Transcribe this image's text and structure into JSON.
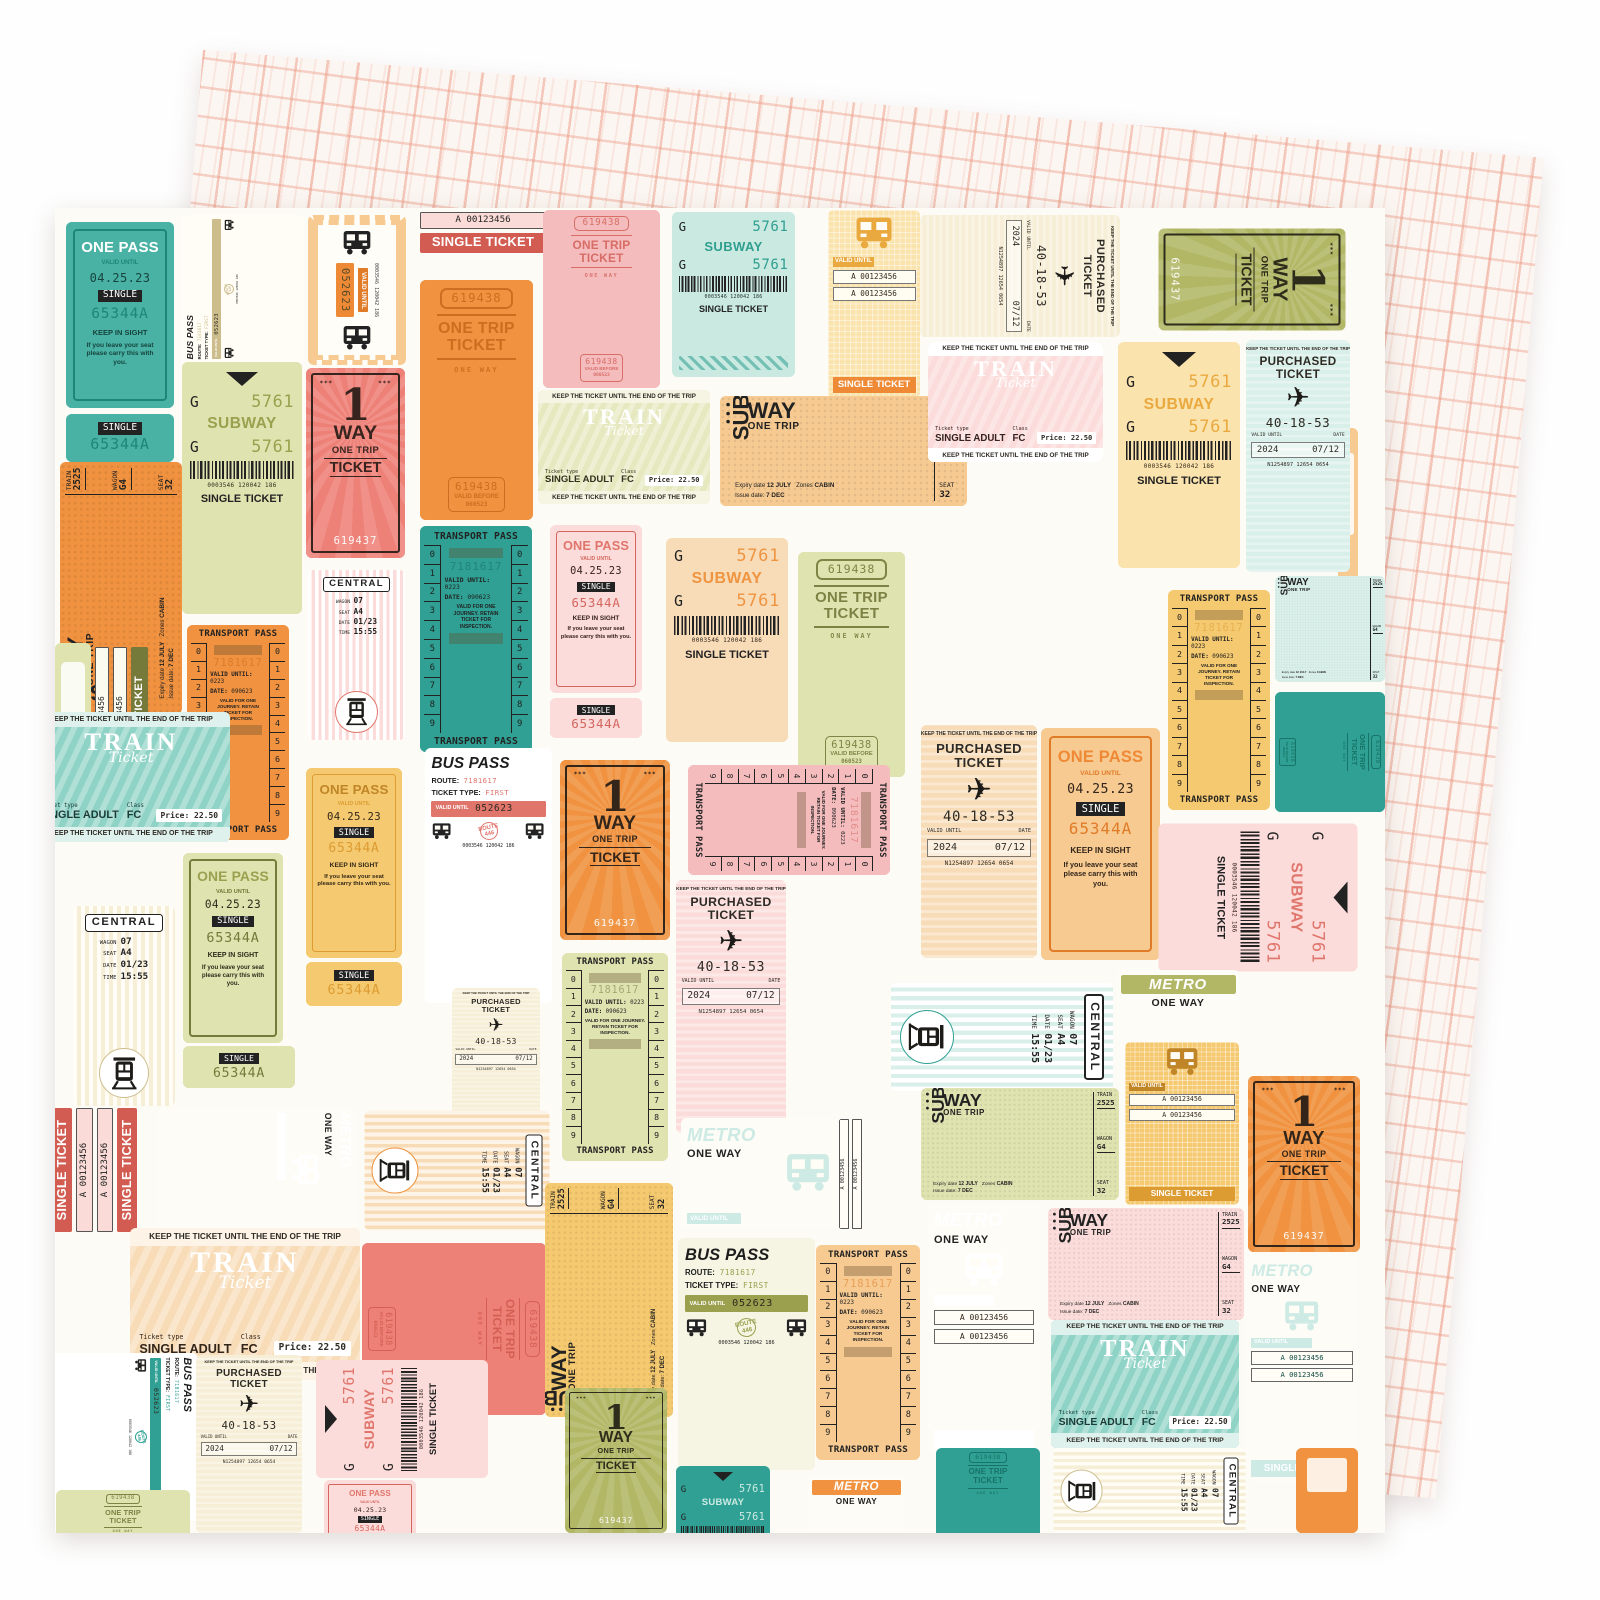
{
  "product": {
    "front_description": "Vintage transit ticket collage patterned paper",
    "back_description": "Pink hand-drawn grid patterned paper"
  },
  "palettes": {
    "teal": {
      "bg": "#49b2a4",
      "ink": "#16443d",
      "acc": "#ffffff",
      "dp": "#1f8578",
      "lt": "#dcf0ec"
    },
    "tealL": {
      "bg": "#c9e9e1",
      "ink": "#22302d",
      "acc": "#2f9f90",
      "dp": "#16796d",
      "lt": "#ffffff"
    },
    "tealD": {
      "bg": "#2fa093",
      "ink": "#0f4a42",
      "acc": "#cdeae4",
      "dp": "#156f64",
      "lt": "#e9f6f3"
    },
    "tealM": {
      "bg": "#8fd2c6",
      "ink": "#1c3b36",
      "acc": "#ffffff",
      "dp": "#2d9a8c",
      "lt": "#dff1ed"
    },
    "mint": {
      "bg": "#d9efe9",
      "ink": "#22302d",
      "acc": "#2fa093",
      "dp": "#1b7c70",
      "lt": "#ffffff"
    },
    "olive": {
      "bg": "#b2b766",
      "ink": "#2e2c1b",
      "acc": "#ffffff",
      "dp": "#6f743a",
      "lt": "#eff0da"
    },
    "oliveL": {
      "bg": "#dfe3b0",
      "ink": "#2e2c1b",
      "acc": "#9aa04e",
      "dp": "#75793a",
      "lt": "#fbfbef"
    },
    "lime": {
      "bg": "#e6e9c0",
      "ink": "#33311f",
      "acc": "#9aa04e",
      "dp": "#8f9448",
      "lt": "#f6f5e3"
    },
    "orange": {
      "bg": "#f0923f",
      "ink": "#33251a",
      "acc": "#ffffff",
      "dp": "#c96a1e",
      "lt": "#fbe3c8"
    },
    "orangeL": {
      "bg": "#f7ca92",
      "ink": "#33251a",
      "acc": "#ee8a35",
      "dp": "#e07b28",
      "lt": "#fef7ec"
    },
    "peach": {
      "bg": "#f8dcb8",
      "ink": "#33251a",
      "acc": "#ef9440",
      "dp": "#e78a32",
      "lt": "#fdf4e7"
    },
    "yellow": {
      "bg": "#f5c96f",
      "ink": "#33281a",
      "acc": "#c08527",
      "dp": "#dd9c32",
      "lt": "#fbeccb"
    },
    "yellowL": {
      "bg": "#fae3ad",
      "ink": "#33281a",
      "acc": "#eaa93f",
      "dp": "#ee8a35",
      "lt": "#fffaf0"
    },
    "cream": {
      "bg": "#f6eed6",
      "ink": "#2e2a22",
      "acc": "#cdbd8d",
      "dp": "#b3a26e",
      "lt": "#fffdf6"
    },
    "coral": {
      "bg": "#ee8177",
      "ink": "#38241f",
      "acc": "#ffffff",
      "dp": "#d25c51",
      "lt": "#fadbd7"
    },
    "pink": {
      "bg": "#f5bcbe",
      "ink": "#35221f",
      "acc": "#ffffff",
      "dp": "#d4665e",
      "lt": "#fde9e8"
    },
    "pinkL": {
      "bg": "#fbdcda",
      "ink": "#35221f",
      "acc": "#e0756c",
      "dp": "#d4665e",
      "lt": "#ffffff"
    }
  },
  "texts": {
    "one_pass": {
      "title": "ONE PASS",
      "valid": "VALID UNTIL",
      "date": "04.25.23",
      "single": "SINGLE",
      "number": "65344A",
      "keep": "KEEP IN SIGHT",
      "keep2": "If you leave your seat please carry this with you."
    },
    "one_way": {
      "stars": "***",
      "one": "1",
      "way": "WAY",
      "trip": "ONE TRIP",
      "ticket": "TICKET",
      "number": "619437"
    },
    "one_trip": {
      "number": "619438",
      "big1": "ONE TRIP",
      "big2": "TICKET",
      "way": "ONE WAY",
      "valid": "VALID BEFORE",
      "date": "060523"
    },
    "subway": {
      "g": "G",
      "num": "5761",
      "title": "SUBWAY",
      "code": "0003546 120042 186",
      "single": "SINGLE TICKET"
    },
    "train": {
      "keep": "KEEP THE TICKET UNTIL THE END OF THE TRIP",
      "title": "TRAIN",
      "script": "Ticket",
      "tt": "Ticket type",
      "type": "SINGLE ADULT",
      "cl": "Class",
      "fc": "FC",
      "price": "Price: 22.50"
    },
    "subway_trip": {
      "sub": "SUB",
      "way": "WAY",
      "trip": "ONE TRIP",
      "train": "TRAIN",
      "train_no": "2525",
      "wagon": "WAGON",
      "wagon_no": "G4",
      "seat": "SEAT",
      "seat_no": "32",
      "e1": "Expiry date",
      "e1v": "12 JULY",
      "e2": "Zones",
      "e2v": "CABIN",
      "e3": "Issue date:",
      "e3v": "7 DEC"
    },
    "purchased": {
      "keep": "KEEP THE TICKET UNTIL THE END OF THE TRIP",
      "t1": "PURCHASED",
      "t2": "TICKET",
      "num": "40-18-53",
      "valid": "VALID UNTIL",
      "date": "DATE",
      "year": "2024",
      "day": "07/12",
      "serial": "N1254897 12654 0654"
    },
    "transport": {
      "title": "TRANSPORT PASS",
      "digits": [
        "0",
        "1",
        "2",
        "3",
        "4",
        "5",
        "6",
        "7",
        "8",
        "9"
      ],
      "num": "7181617",
      "valid": "VALID UNTIL:",
      "validv": "0223",
      "date": "DATE:",
      "datev": "090623",
      "note": "VALID FOR ONE JOURNEY. RETAIN TICKET FOR INSPECTION."
    },
    "central": {
      "title": "CENTRAL",
      "wagon": "WAGON",
      "wagon_no": "07",
      "seat": "SEAT",
      "seat_no": "A4",
      "date": "DATE",
      "date_v": "01/23",
      "time": "TIME",
      "time_v": "15:55"
    },
    "metro": {
      "title": "METRO",
      "way": "ONE WAY",
      "valid": "VALID UNTIL"
    },
    "strip": {
      "num": "A 00123456",
      "single": "SINGLE TICKET"
    },
    "bus": {
      "title": "BUS PASS",
      "route": "ROUTE:",
      "route_v": "7181617",
      "type": "TICKET TYPE:",
      "type_v": "FIRST",
      "valid": "VALID UNTIL",
      "valid_v": "052623",
      "badge": "ROUTE 446",
      "code": "0003546 120042 186"
    }
  },
  "tickets": [
    {
      "t": "one_pass",
      "p": "teal",
      "x": 11,
      "y": 14,
      "w": 108,
      "h": 186
    },
    {
      "t": "stub",
      "p": "teal",
      "x": 11,
      "y": 206,
      "w": 108,
      "h": 48
    },
    {
      "t": "bus",
      "p": "cream",
      "x": 127,
      "y": 7,
      "w": 122,
      "h": 148,
      "r": -90
    },
    {
      "t": "bus_mini",
      "p": "orangeL",
      "x": 253,
      "y": 7,
      "w": 98,
      "h": 150
    },
    {
      "t": "single_strip",
      "p": "coral",
      "x": 363,
      "y": 2,
      "w": 130,
      "h": 100,
      "o": {
        "boxes": 1,
        "banner": 1
      }
    },
    {
      "t": "one_trip",
      "p": "orange",
      "x": 365,
      "y": 72,
      "w": 113,
      "h": 240
    },
    {
      "t": "one_trip",
      "p": "pink",
      "x": 488,
      "y": 2,
      "w": 117,
      "h": 178
    },
    {
      "t": "subway",
      "p": "tealL",
      "x": 617,
      "y": 4,
      "w": 123,
      "h": 165,
      "o": {
        "hatch": 1
      }
    },
    {
      "t": "bus_block",
      "p": "yellowL",
      "x": 773,
      "y": 2,
      "w": 92,
      "h": 188,
      "o": {
        "strips": 2,
        "ban": 1
      }
    },
    {
      "t": "purchased",
      "p": "cream",
      "x": 865,
      "y": 7,
      "w": 200,
      "h": 122,
      "r": 90
    },
    {
      "t": "one_way",
      "p": "olive",
      "x": 1103,
      "y": 20,
      "w": 187,
      "h": 102,
      "r": 90
    },
    {
      "t": "sliver",
      "p": "orangeL",
      "x": 1283,
      "y": 220,
      "w": 20,
      "h": 205
    },
    {
      "t": "subway_trip",
      "p": "orange",
      "x": 5,
      "y": 254,
      "w": 122,
      "h": 252,
      "r": -90
    },
    {
      "t": "subway",
      "p": "oliveL",
      "x": 127,
      "y": 154,
      "w": 120,
      "h": 252,
      "o": {
        "tri": 1
      }
    },
    {
      "t": "one_way",
      "p": "coral",
      "x": 251,
      "y": 160,
      "w": 99,
      "h": 190
    },
    {
      "t": "central",
      "p": "pinkL",
      "x": 253,
      "y": 362,
      "w": 97,
      "h": 170
    },
    {
      "t": "train",
      "p": "lime",
      "x": 483,
      "y": 182,
      "w": 172,
      "h": 114
    },
    {
      "t": "one_pass",
      "p": "pinkL",
      "x": 495,
      "y": 317,
      "w": 92,
      "h": 168
    },
    {
      "t": "stub",
      "p": "pinkL",
      "x": 495,
      "y": 490,
      "w": 92,
      "h": 40
    },
    {
      "t": "subway_trip",
      "p": "orangeL",
      "x": 665,
      "y": 188,
      "w": 247,
      "h": 110
    },
    {
      "t": "train",
      "p": "pinkL",
      "x": 873,
      "y": 134,
      "w": 175,
      "h": 120
    },
    {
      "t": "subway",
      "p": "yellowL",
      "x": 1063,
      "y": 134,
      "w": 122,
      "h": 226,
      "o": {
        "tri": 1
      }
    },
    {
      "t": "purchased",
      "p": "mint",
      "x": 1191,
      "y": 132,
      "w": 104,
      "h": 232
    },
    {
      "t": "transport",
      "p": "orange",
      "x": 132,
      "y": 417,
      "w": 102,
      "h": 215
    },
    {
      "t": "single_strip",
      "p": "oliveL",
      "x": 38,
      "y": 437,
      "w": 86,
      "h": 150,
      "r": -90,
      "o": {
        "boxes": 2,
        "banner": 1
      }
    },
    {
      "t": "sliver",
      "p": "oliveL",
      "x": 0,
      "y": 435,
      "w": 36,
      "h": 155
    },
    {
      "t": "transport",
      "p": "tealD",
      "x": 365,
      "y": 318,
      "w": 112,
      "h": 226
    },
    {
      "t": "subway",
      "p": "peach",
      "x": 611,
      "y": 330,
      "w": 122,
      "h": 204
    },
    {
      "t": "one_trip",
      "p": "oliveL",
      "x": 743,
      "y": 344,
      "w": 107,
      "h": 225
    },
    {
      "t": "transport",
      "p": "yellow",
      "x": 1113,
      "y": 382,
      "w": 102,
      "h": 220
    },
    {
      "t": "subway_trip",
      "p": "mint",
      "x": 1220,
      "y": 368,
      "w": 110,
      "h": 106
    },
    {
      "t": "one_trip",
      "p": "tealD",
      "x": 1220,
      "y": 484,
      "w": 110,
      "h": 120,
      "r": 90
    },
    {
      "t": "train",
      "p": "tealM",
      "x": -23,
      "y": 504,
      "w": 198,
      "h": 130
    },
    {
      "t": "one_pass",
      "p": "oliveL",
      "x": 128,
      "y": 645,
      "w": 100,
      "h": 190
    },
    {
      "t": "stub",
      "p": "oliveL",
      "x": 128,
      "y": 838,
      "w": 112,
      "h": 42
    },
    {
      "t": "central",
      "p": "cream",
      "x": 18,
      "y": 698,
      "w": 102,
      "h": 200
    },
    {
      "t": "bus",
      "p": "pinkL",
      "x": 370,
      "y": 540,
      "w": 127,
      "h": 255
    },
    {
      "t": "one_way",
      "p": "orange",
      "x": 505,
      "y": 552,
      "w": 110,
      "h": 180
    },
    {
      "t": "transport",
      "p": "pink",
      "x": 633,
      "y": 557,
      "w": 202,
      "h": 110,
      "r": 90
    },
    {
      "t": "purchased",
      "p": "pinkL",
      "x": 621,
      "y": 672,
      "w": 110,
      "h": 253
    },
    {
      "t": "purchased",
      "p": "peach",
      "x": 866,
      "y": 517,
      "w": 116,
      "h": 233
    },
    {
      "t": "one_pass",
      "p": "orangeL",
      "x": 986,
      "y": 520,
      "w": 119,
      "h": 232
    },
    {
      "t": "one_pass",
      "p": "yellow",
      "x": 251,
      "y": 560,
      "w": 96,
      "h": 190
    },
    {
      "t": "stub",
      "p": "yellow",
      "x": 251,
      "y": 754,
      "w": 96,
      "h": 44
    },
    {
      "t": "subway",
      "p": "pinkL",
      "x": 1103,
      "y": 615,
      "w": 199,
      "h": 148,
      "r": 90,
      "o": {
        "tri": 1
      }
    },
    {
      "t": "central",
      "p": "mint",
      "x": 836,
      "y": 775,
      "w": 222,
      "h": 108,
      "r": 90
    },
    {
      "t": "metro_banner",
      "p": "olive",
      "x": 1061,
      "y": 762,
      "w": 124,
      "h": 72
    },
    {
      "t": "bus_block",
      "p": "yellow",
      "x": 1070,
      "y": 834,
      "w": 114,
      "h": 163,
      "o": {
        "strips": 2,
        "ban": 1
      }
    },
    {
      "t": "purchased",
      "p": "cream",
      "x": 397,
      "y": 780,
      "w": 88,
      "h": 134
    },
    {
      "t": "single_strip",
      "p": "coral",
      "x": -5,
      "y": 898,
      "w": 112,
      "h": 128,
      "r": -90,
      "o": {
        "boxes": 2,
        "banner": 1,
        "topban": 1
      }
    },
    {
      "t": "metro",
      "p": "orange",
      "x": 103,
      "y": 900,
      "w": 200,
      "h": 122,
      "r": 90
    },
    {
      "t": "central",
      "p": "peach",
      "x": 309,
      "y": 902,
      "w": 185,
      "h": 120,
      "r": 90
    },
    {
      "t": "transport",
      "p": "oliveL",
      "x": 507,
      "y": 745,
      "w": 106,
      "h": 208
    },
    {
      "t": "metro_h",
      "p": "tealD",
      "x": 626,
      "y": 910,
      "w": 158,
      "h": 112
    },
    {
      "t": "single_strip",
      "p": "cream",
      "x": 783,
      "y": 910,
      "w": 56,
      "h": 112,
      "r": -90,
      "o": {
        "boxes": 2
      }
    },
    {
      "t": "train",
      "p": "peach",
      "x": 75,
      "y": 1020,
      "w": 230,
      "h": 152
    },
    {
      "t": "one_trip",
      "p": "coral",
      "x": 307,
      "y": 1035,
      "w": 184,
      "h": 172,
      "r": 90
    },
    {
      "t": "subway_trip",
      "p": "yellow",
      "x": 490,
      "y": 975,
      "w": 128,
      "h": 234,
      "r": -90
    },
    {
      "t": "bus",
      "p": "lime",
      "x": 623,
      "y": 1030,
      "w": 137,
      "h": 232
    },
    {
      "t": "transport",
      "p": "orangeL",
      "x": 761,
      "y": 1037,
      "w": 104,
      "h": 215
    },
    {
      "t": "metro",
      "p": "orange",
      "x": 873,
      "y": 995,
      "w": 112,
      "h": 252,
      "o": {
        "strips": 2,
        "ban": 1
      }
    },
    {
      "t": "subway_trip",
      "p": "oliveL",
      "x": 866,
      "y": 880,
      "w": 198,
      "h": 112
    },
    {
      "t": "subway_trip",
      "p": "pinkL",
      "x": 993,
      "y": 1000,
      "w": 196,
      "h": 112
    },
    {
      "t": "train",
      "p": "tealM",
      "x": 996,
      "y": 1112,
      "w": 188,
      "h": 128
    },
    {
      "t": "one_way",
      "p": "orange",
      "x": 1193,
      "y": 868,
      "w": 112,
      "h": 176
    },
    {
      "t": "metro",
      "p": "tealD",
      "x": 1191,
      "y": 1048,
      "w": 112,
      "h": 226,
      "o": {
        "strips": 2,
        "ban": 1
      }
    },
    {
      "t": "bus",
      "p": "mint",
      "x": -7,
      "y": 1145,
      "w": 150,
      "h": 168,
      "r": 90
    },
    {
      "t": "purchased",
      "p": "cream",
      "x": 141,
      "y": 1147,
      "w": 106,
      "h": 178
    },
    {
      "t": "subway",
      "p": "pinkL",
      "x": 261,
      "y": 1152,
      "w": 172,
      "h": 118,
      "r": -90,
      "o": {
        "tri": 1
      }
    },
    {
      "t": "one_pass",
      "p": "pinkL",
      "x": 269,
      "y": 1272,
      "w": 92,
      "h": 100
    },
    {
      "t": "one_way",
      "p": "olive",
      "x": 510,
      "y": 1180,
      "w": 102,
      "h": 145
    },
    {
      "t": "subway",
      "p": "tealD",
      "x": 621,
      "y": 1258,
      "w": 94,
      "h": 120,
      "o": {
        "tri": 1
      }
    },
    {
      "t": "metro_banner",
      "p": "orange",
      "x": 753,
      "y": 1268,
      "w": 97,
      "h": 57
    },
    {
      "t": "one_trip",
      "p": "tealD",
      "x": 881,
      "y": 1240,
      "w": 104,
      "h": 120
    },
    {
      "t": "central",
      "p": "cream",
      "x": 998,
      "y": 1240,
      "w": 192,
      "h": 85,
      "r": 90
    },
    {
      "t": "sliver",
      "p": "orange",
      "x": 1241,
      "y": 1240,
      "w": 62,
      "h": 85
    },
    {
      "t": "one_trip",
      "p": "oliveL",
      "x": 1,
      "y": 1282,
      "w": 134,
      "h": 110
    }
  ]
}
